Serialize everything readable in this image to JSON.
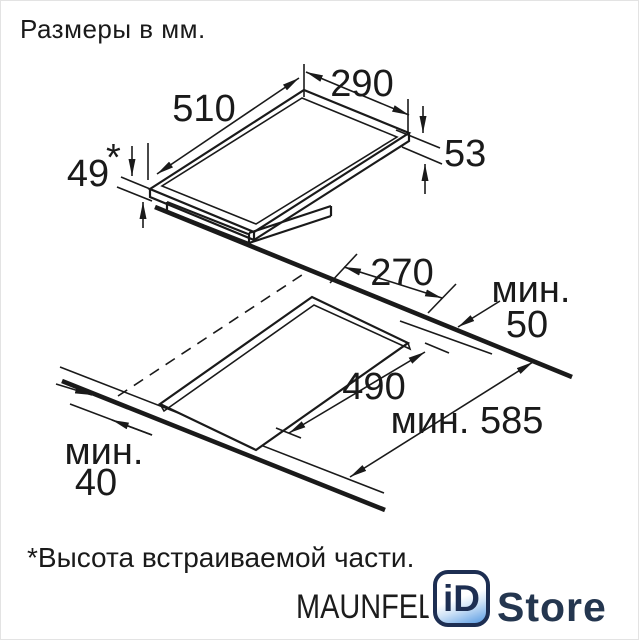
{
  "header": {
    "title": "Размеры в мм."
  },
  "footnote": "*Высота встраиваемой части.",
  "brand": "MAUNFELD",
  "logo": {
    "id": "iD",
    "store": "Store"
  },
  "colors": {
    "ink": "#1a1a1a",
    "logo_navy": "#1d2e52",
    "logo_blue": "#66a3e4"
  },
  "dimensions": {
    "top_width": "510",
    "top_depth": "290",
    "edge_height": "53",
    "body_height": "49",
    "body_height_star": "*",
    "cutout_depth": "270",
    "side_clearance_label": "мин.",
    "side_clearance_value": "50",
    "cutout_width": "490",
    "worktop_depth": "мин. 585",
    "front_clearance_label": "мин.",
    "front_clearance_value": "40"
  }
}
